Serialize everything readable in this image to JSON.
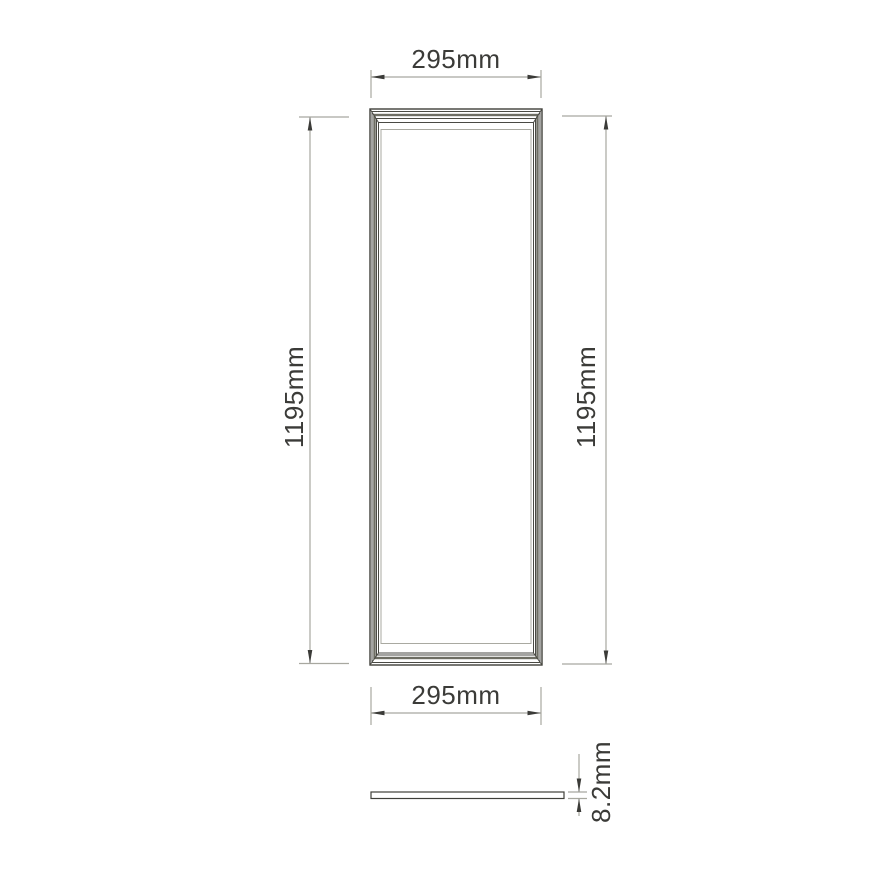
{
  "drawing": {
    "type": "product-dimension-diagram",
    "front_view": {
      "dim_top": "295mm",
      "dim_bottom": "295mm",
      "dim_left": "1195mm",
      "dim_right": "1195mm"
    },
    "side_view": {
      "dim_thickness": "8.2mm"
    },
    "dimensions_mm": {
      "width": 295,
      "height": 1195,
      "thickness": 8.2
    },
    "colors": {
      "background": "#ffffff",
      "outline_dark": "#3f3f39",
      "frame_mid": "#6d6d63",
      "faint_line": "#a9a9a1",
      "dimension_line": "#a8a8a0",
      "text": "#3b3b38"
    }
  }
}
